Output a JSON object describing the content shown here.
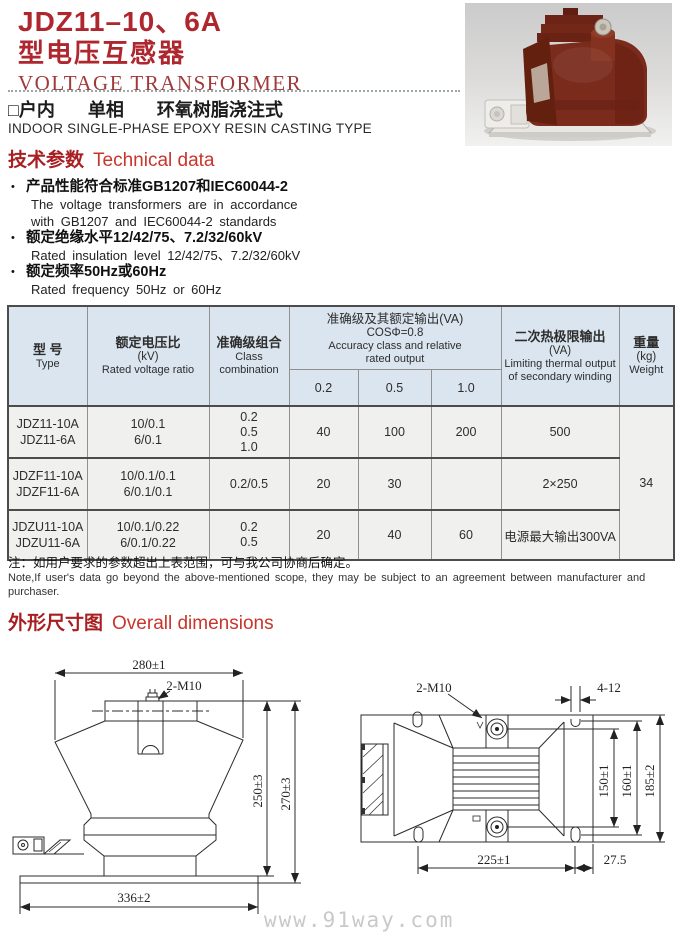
{
  "header": {
    "model": "JDZ11–10、6A",
    "type_cn": "型电压互感器",
    "title_en": "VOLTAGE TRANSFORMER"
  },
  "subtitle": {
    "items": [
      "□户内",
      "单相",
      "环氧树脂浇注式"
    ],
    "en": "INDOOR SINGLE-PHASE EPOXY RESIN CASTING TYPE"
  },
  "tech": {
    "heading_cn": "技术参数",
    "heading_en": "Technical data",
    "items": [
      {
        "cn": "产品性能符合标准GB1207和IEC60044-2",
        "en": [
          "The voltage transformers are in accordance",
          "with GB1207 and IEC60044-2 standards"
        ]
      },
      {
        "cn": "额定绝缘水平12/42/75、7.2/32/60kV",
        "en": [
          "Rated insulation level 12/42/75、7.2/32/60kV"
        ]
      },
      {
        "cn": "额定频率50Hz或60Hz",
        "en": [
          "Rated frequency 50Hz or 60Hz"
        ]
      }
    ]
  },
  "table": {
    "headers": {
      "type": {
        "cn": "型 号",
        "en": "Type"
      },
      "ratio": {
        "cn": "额定电压比",
        "sub": "(kV)",
        "en": "Rated voltage ratio"
      },
      "class_combo": {
        "cn": "准确级组合",
        "en1": "Class",
        "en2": "combination"
      },
      "accuracy": {
        "cn": "准确级及其额定输出(VA)",
        "sub": "COSΦ=0.8",
        "en1": "Accuracy class and relative",
        "en2": "rated output",
        "cols": [
          "0.2",
          "0.5",
          "1.0"
        ]
      },
      "thermal": {
        "cn": "二次热极限输出",
        "sub": "(VA)",
        "en1": "Limiting thermal output",
        "en2": "of secondary winding"
      },
      "weight": {
        "cn": "重量",
        "sub": "(kg)",
        "en": "Weight"
      }
    },
    "rows": [
      {
        "type": [
          "JDZ11-10A",
          "JDZ11-6A"
        ],
        "ratio": [
          "10/0.1",
          "6/0.1"
        ],
        "class_combo": [
          "0.2",
          "0.5",
          "1.0"
        ],
        "outputs": [
          "40",
          "100",
          "200"
        ],
        "thermal": "500"
      },
      {
        "type": [
          "JDZF11-10A",
          "JDZF11-6A"
        ],
        "ratio": [
          "10/0.1/0.1",
          "6/0.1/0.1"
        ],
        "class_combo": [
          "0.2/0.5"
        ],
        "outputs": [
          "20",
          "30",
          ""
        ],
        "thermal": "2×250"
      },
      {
        "type": [
          "JDZU11-10A",
          "JDZU11-6A"
        ],
        "ratio": [
          "10/0.1/0.22",
          "6/0.1/0.22"
        ],
        "class_combo": [
          "0.2",
          "0.5"
        ],
        "outputs": [
          "20",
          "40",
          "60"
        ],
        "thermal": "电源最大输出300VA"
      }
    ],
    "weight_value": "34"
  },
  "note": {
    "cn": "注：如用户要求的参数超出上表范围，可与我公司协商后确定。",
    "en": "Note,If user's data go beyond the above-mentioned scope, they may be subject to an agreement between manufacturer and purchaser."
  },
  "dimensions": {
    "heading_cn": "外形尺寸图",
    "heading_en": "Overall dimensions",
    "front_view": {
      "width_top": "280±1",
      "bolt": "2-M10",
      "height_inner": "250±3",
      "height_outer": "270±3",
      "width_bottom": "336±2"
    },
    "top_view": {
      "bolt": "2-M10",
      "slot": "4-12",
      "v1": "150±1",
      "v2": "160±1",
      "v3": "185±2",
      "b1": "225±1",
      "b2": "27.5"
    }
  },
  "watermark": "www.91way.com"
}
